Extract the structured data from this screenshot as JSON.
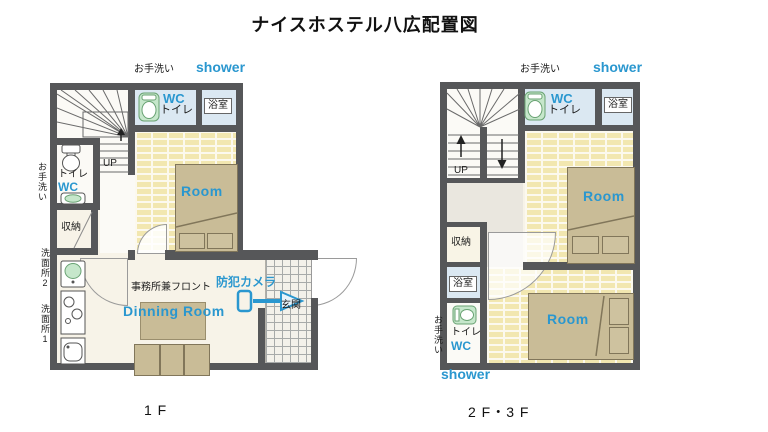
{
  "title": "ナイスホステル八広配置図",
  "accent_color": "#2a97cf",
  "floor1": {
    "caption": "1 F",
    "labels": {
      "wash_top": "お手洗い",
      "shower_top": "shower",
      "wc_top": "WC",
      "toilet_top": "トイレ",
      "bath": "浴室",
      "room": "Room",
      "up": "UP",
      "toilet_left": "トイレ",
      "wc_left": "WC",
      "wash_left": "お手洗い",
      "storage": "収納",
      "washstand2": "洗面所2",
      "washstand1": "洗面所1",
      "office_front": "事務所兼フロント",
      "dining_room": "Dinning Room",
      "security_camera": "防犯カメラ",
      "entrance": "玄関"
    }
  },
  "floor23": {
    "caption": "2 F・3 F",
    "labels": {
      "wash_top": "お手洗い",
      "shower_top": "shower",
      "wc_top": "WC",
      "toilet_top": "トイレ",
      "bath_top": "浴室",
      "room_upper": "Room",
      "up": "UP",
      "storage": "収納",
      "bath_left": "浴室",
      "room_lower": "Room",
      "toilet_bottom": "トイレ",
      "wc_bottom": "WC",
      "wash_left": "お手洗い",
      "shower_bottom": "shower"
    }
  }
}
